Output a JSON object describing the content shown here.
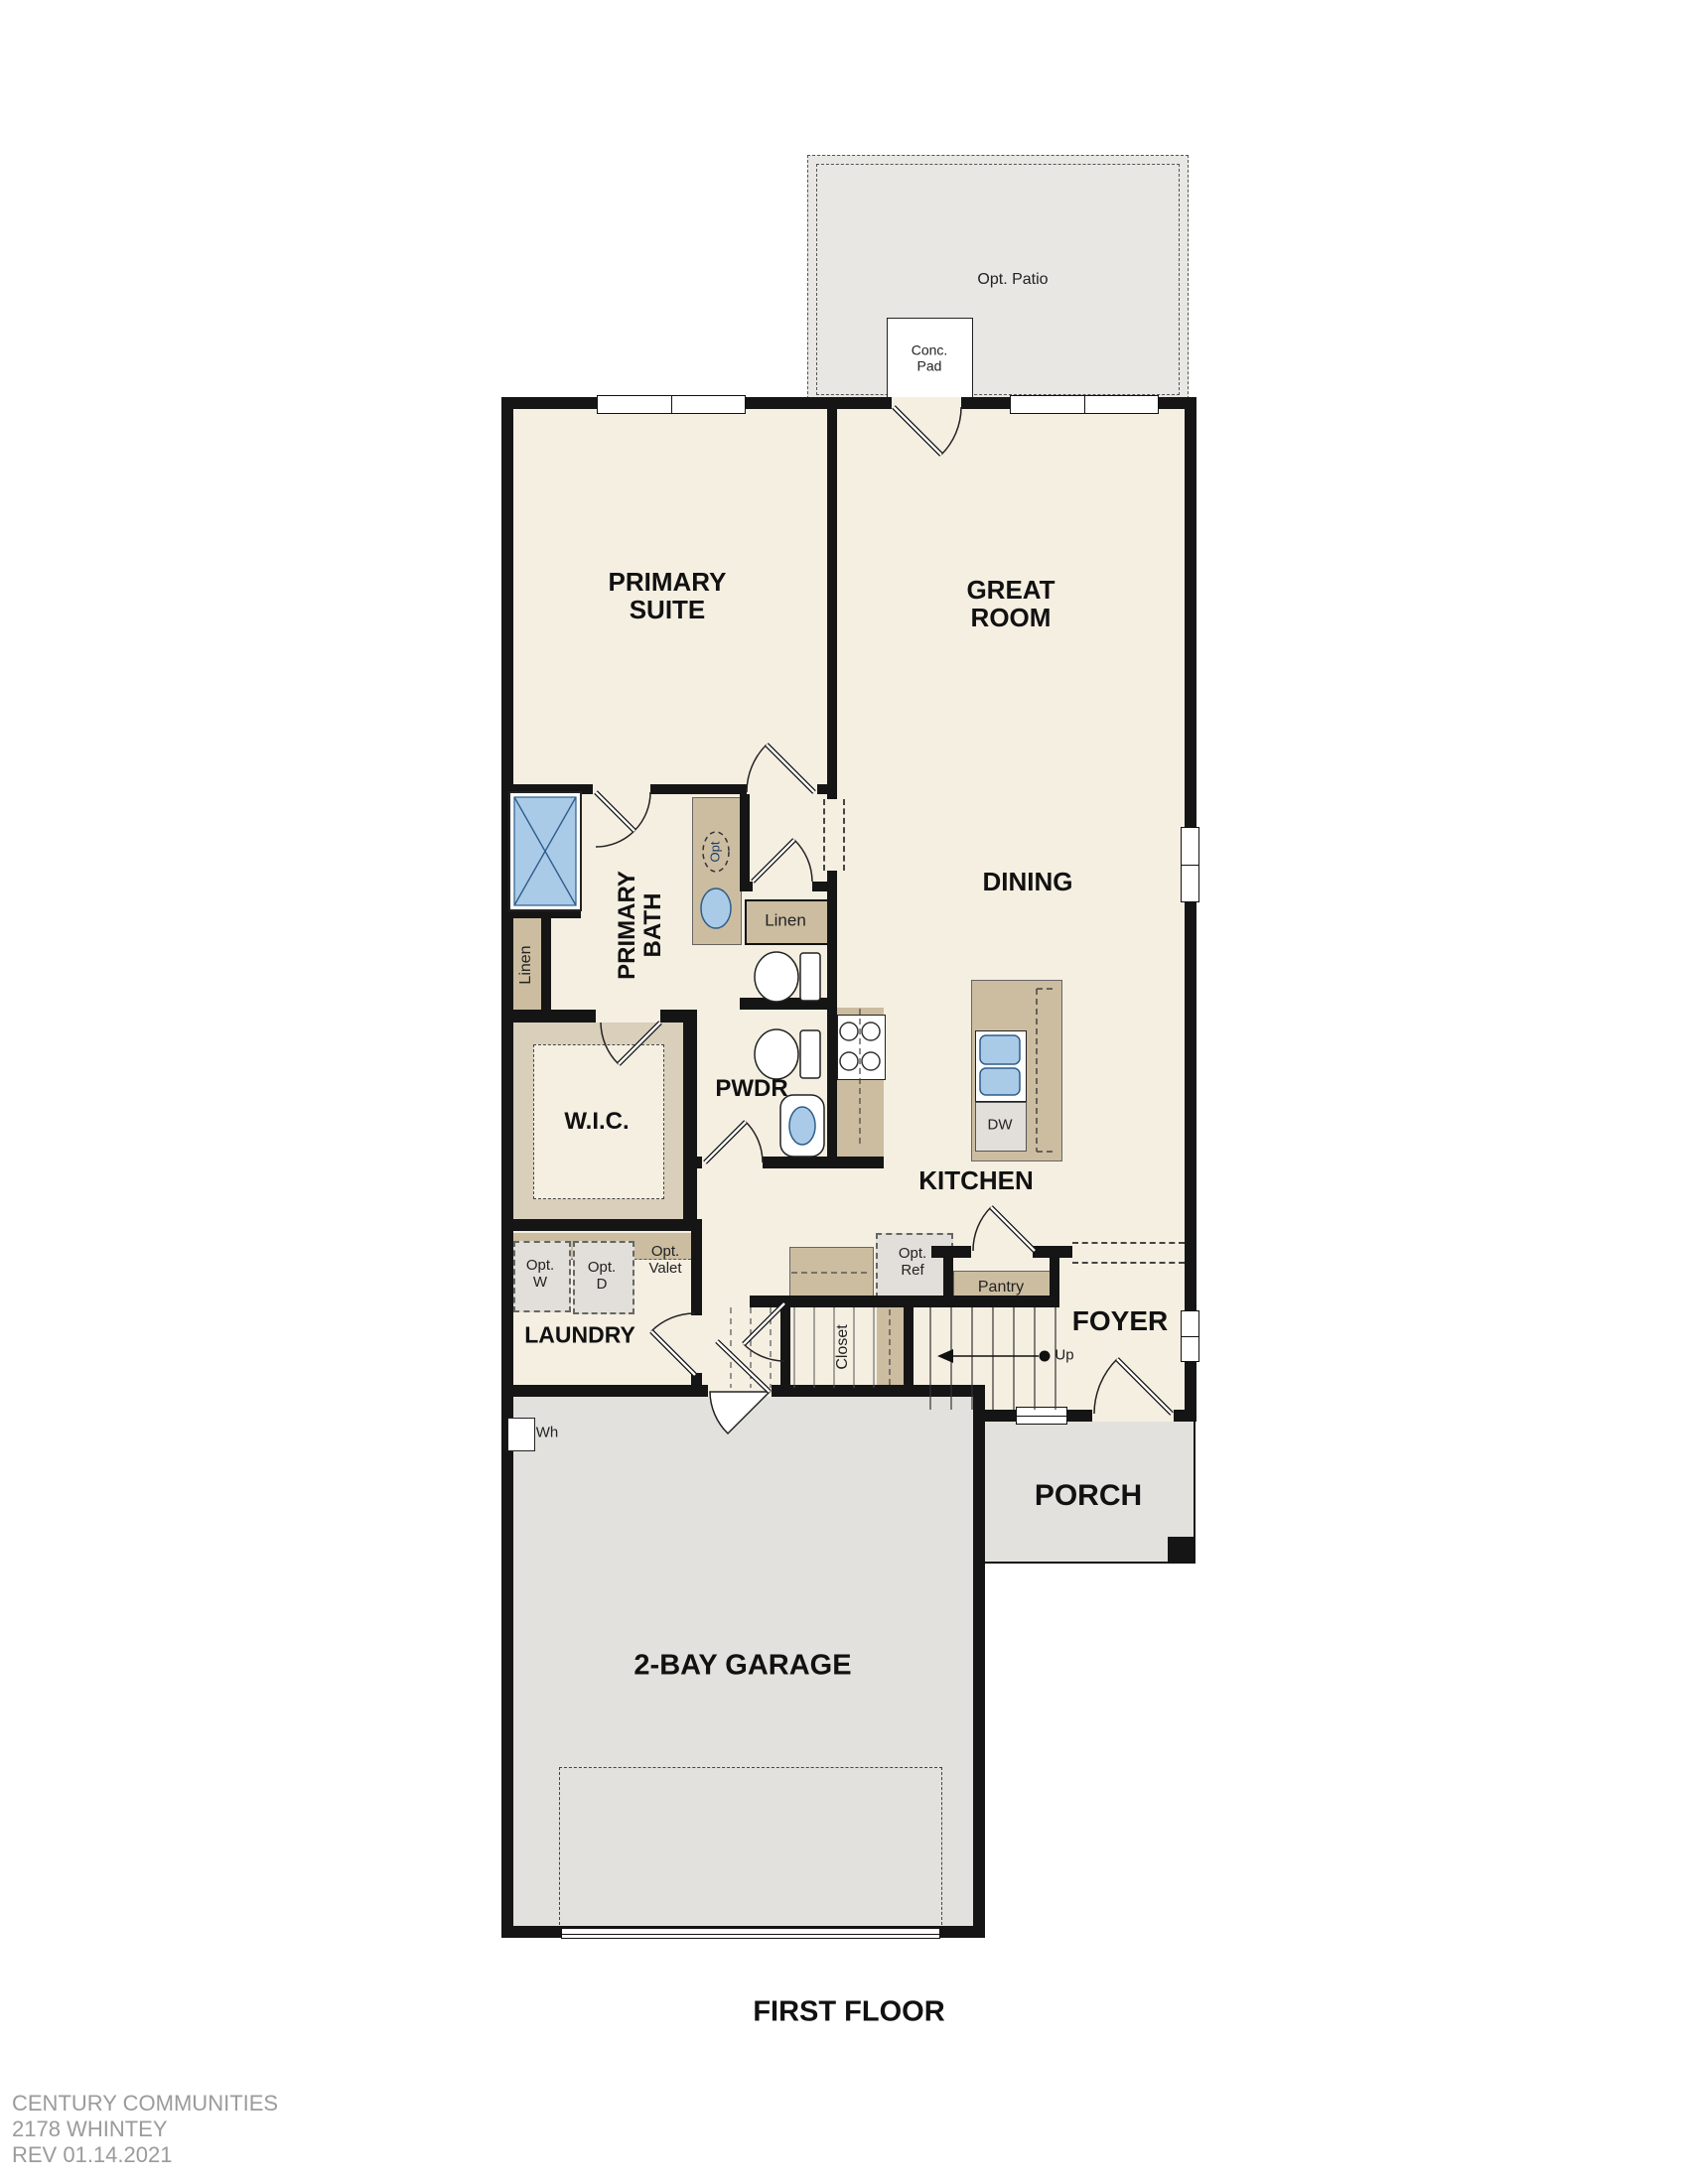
{
  "title": "FIRST FLOOR",
  "footer": {
    "line1": "CENTURY COMMUNITIES",
    "line2": "2178 WHINTEY",
    "line3": "REV 01.14.2021"
  },
  "rooms": {
    "primary_suite": {
      "line1": "PRIMARY",
      "line2": "SUITE"
    },
    "great_room": {
      "line1": "GREAT",
      "line2": "ROOM"
    },
    "dining": {
      "label": "DINING"
    },
    "primary_bath": {
      "line1": "PRIMARY",
      "line2": "BATH"
    },
    "wic": {
      "label": "W.I.C."
    },
    "pwdr": {
      "label": "PWDR"
    },
    "kitchen": {
      "label": "KITCHEN"
    },
    "laundry": {
      "label": "LAUNDRY"
    },
    "foyer": {
      "label": "FOYER"
    },
    "porch": {
      "label": "PORCH"
    },
    "garage": {
      "label": "2-BAY GARAGE"
    }
  },
  "features": {
    "opt_patio": "Opt. Patio",
    "conc_pad": {
      "line1": "Conc.",
      "line2": "Pad"
    },
    "linen_bath": "Linen",
    "linen_hall": "Linen",
    "opt_sink": "Opt",
    "opt_washer": {
      "line1": "Opt.",
      "line2": "W"
    },
    "opt_dryer": {
      "line1": "Opt.",
      "line2": "D"
    },
    "opt_valet": {
      "line1": "Opt.",
      "line2": "Valet"
    },
    "opt_ref": {
      "line1": "Opt.",
      "line2": "Ref"
    },
    "pantry": "Pantry",
    "closet": "Closet",
    "stairs_up": "Up",
    "dishwasher": "DW",
    "water_heater": "Wh"
  },
  "colors": {
    "walls": "#151515",
    "floor": "#f5efe2",
    "garage": "#e3e1dd",
    "porch": "#e3e1dd",
    "patio": "#e9e7e3",
    "cabinet": "#ccbda1",
    "cabinet_light": "#d9cfba",
    "appliance": "#e2dfda",
    "fixture": "#a9cbe8",
    "fixture_border": "#2f5d8a",
    "footer": "#9b9b9b",
    "label": "#111111"
  }
}
